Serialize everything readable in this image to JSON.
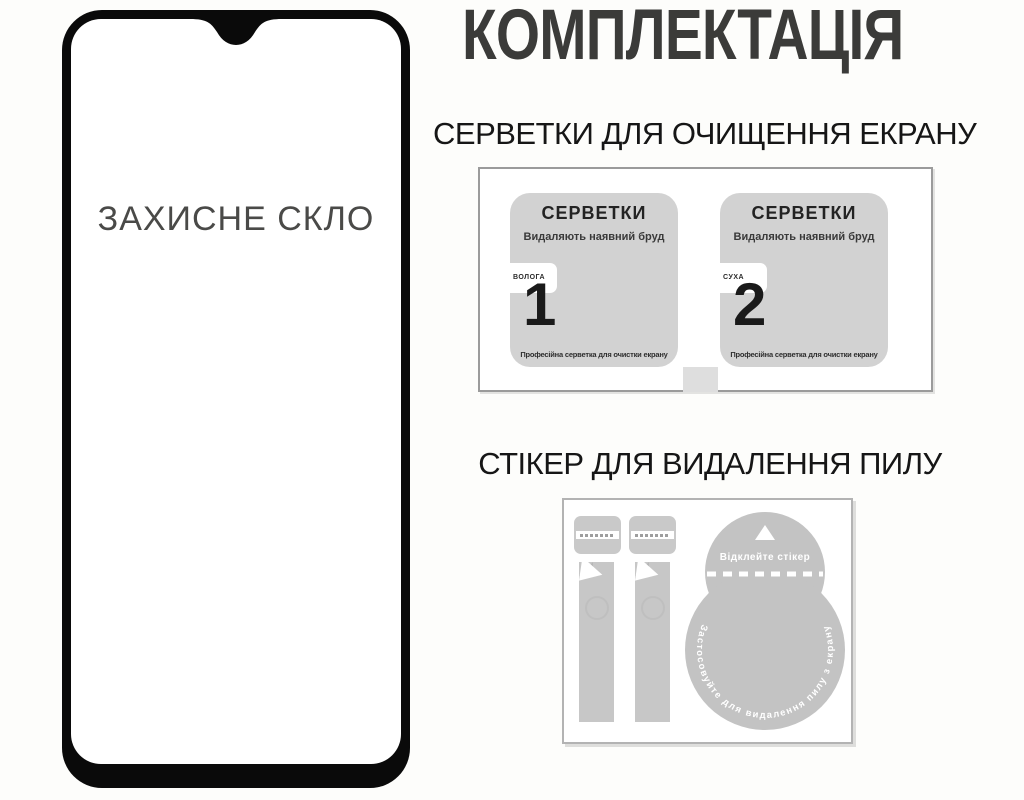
{
  "header": {
    "title": "КОМПЛЕКТАЦІЯ"
  },
  "glass": {
    "label": "ЗАХИСНЕ СКЛО"
  },
  "wipes_section": {
    "heading": "СЕРВЕТКИ ДЛЯ ОЧИЩЕННЯ ЕКРАНУ",
    "wipes": [
      {
        "title": "СЕРВЕТКИ",
        "subtitle": "Видаляють наявний бруд",
        "type_tab": "ВОЛОГА",
        "number": "1",
        "footnote": "Професійна серветка для очистки екрану"
      },
      {
        "title": "СЕРВЕТКИ",
        "subtitle": "Видаляють наявний бруд",
        "type_tab": "СУХА",
        "number": "2",
        "footnote": "Професійна серветка для очистки екрану"
      }
    ]
  },
  "sticker_section": {
    "heading": "СТІКЕР ДЛЯ ВИДАЛЕННЯ ПИЛУ",
    "sticker": {
      "peel_label": "Відклейте стікер",
      "rim_label": "Застосовуйте для видалення пилу з екрану"
    }
  },
  "colors": {
    "background": "#fdfdfb",
    "title_text": "#3b3b39",
    "heading_text": "#161616",
    "frame_black": "#0a0a0a",
    "wipe_gray": "#d2d2d2",
    "sticker_gray": "#c3c3c3"
  }
}
